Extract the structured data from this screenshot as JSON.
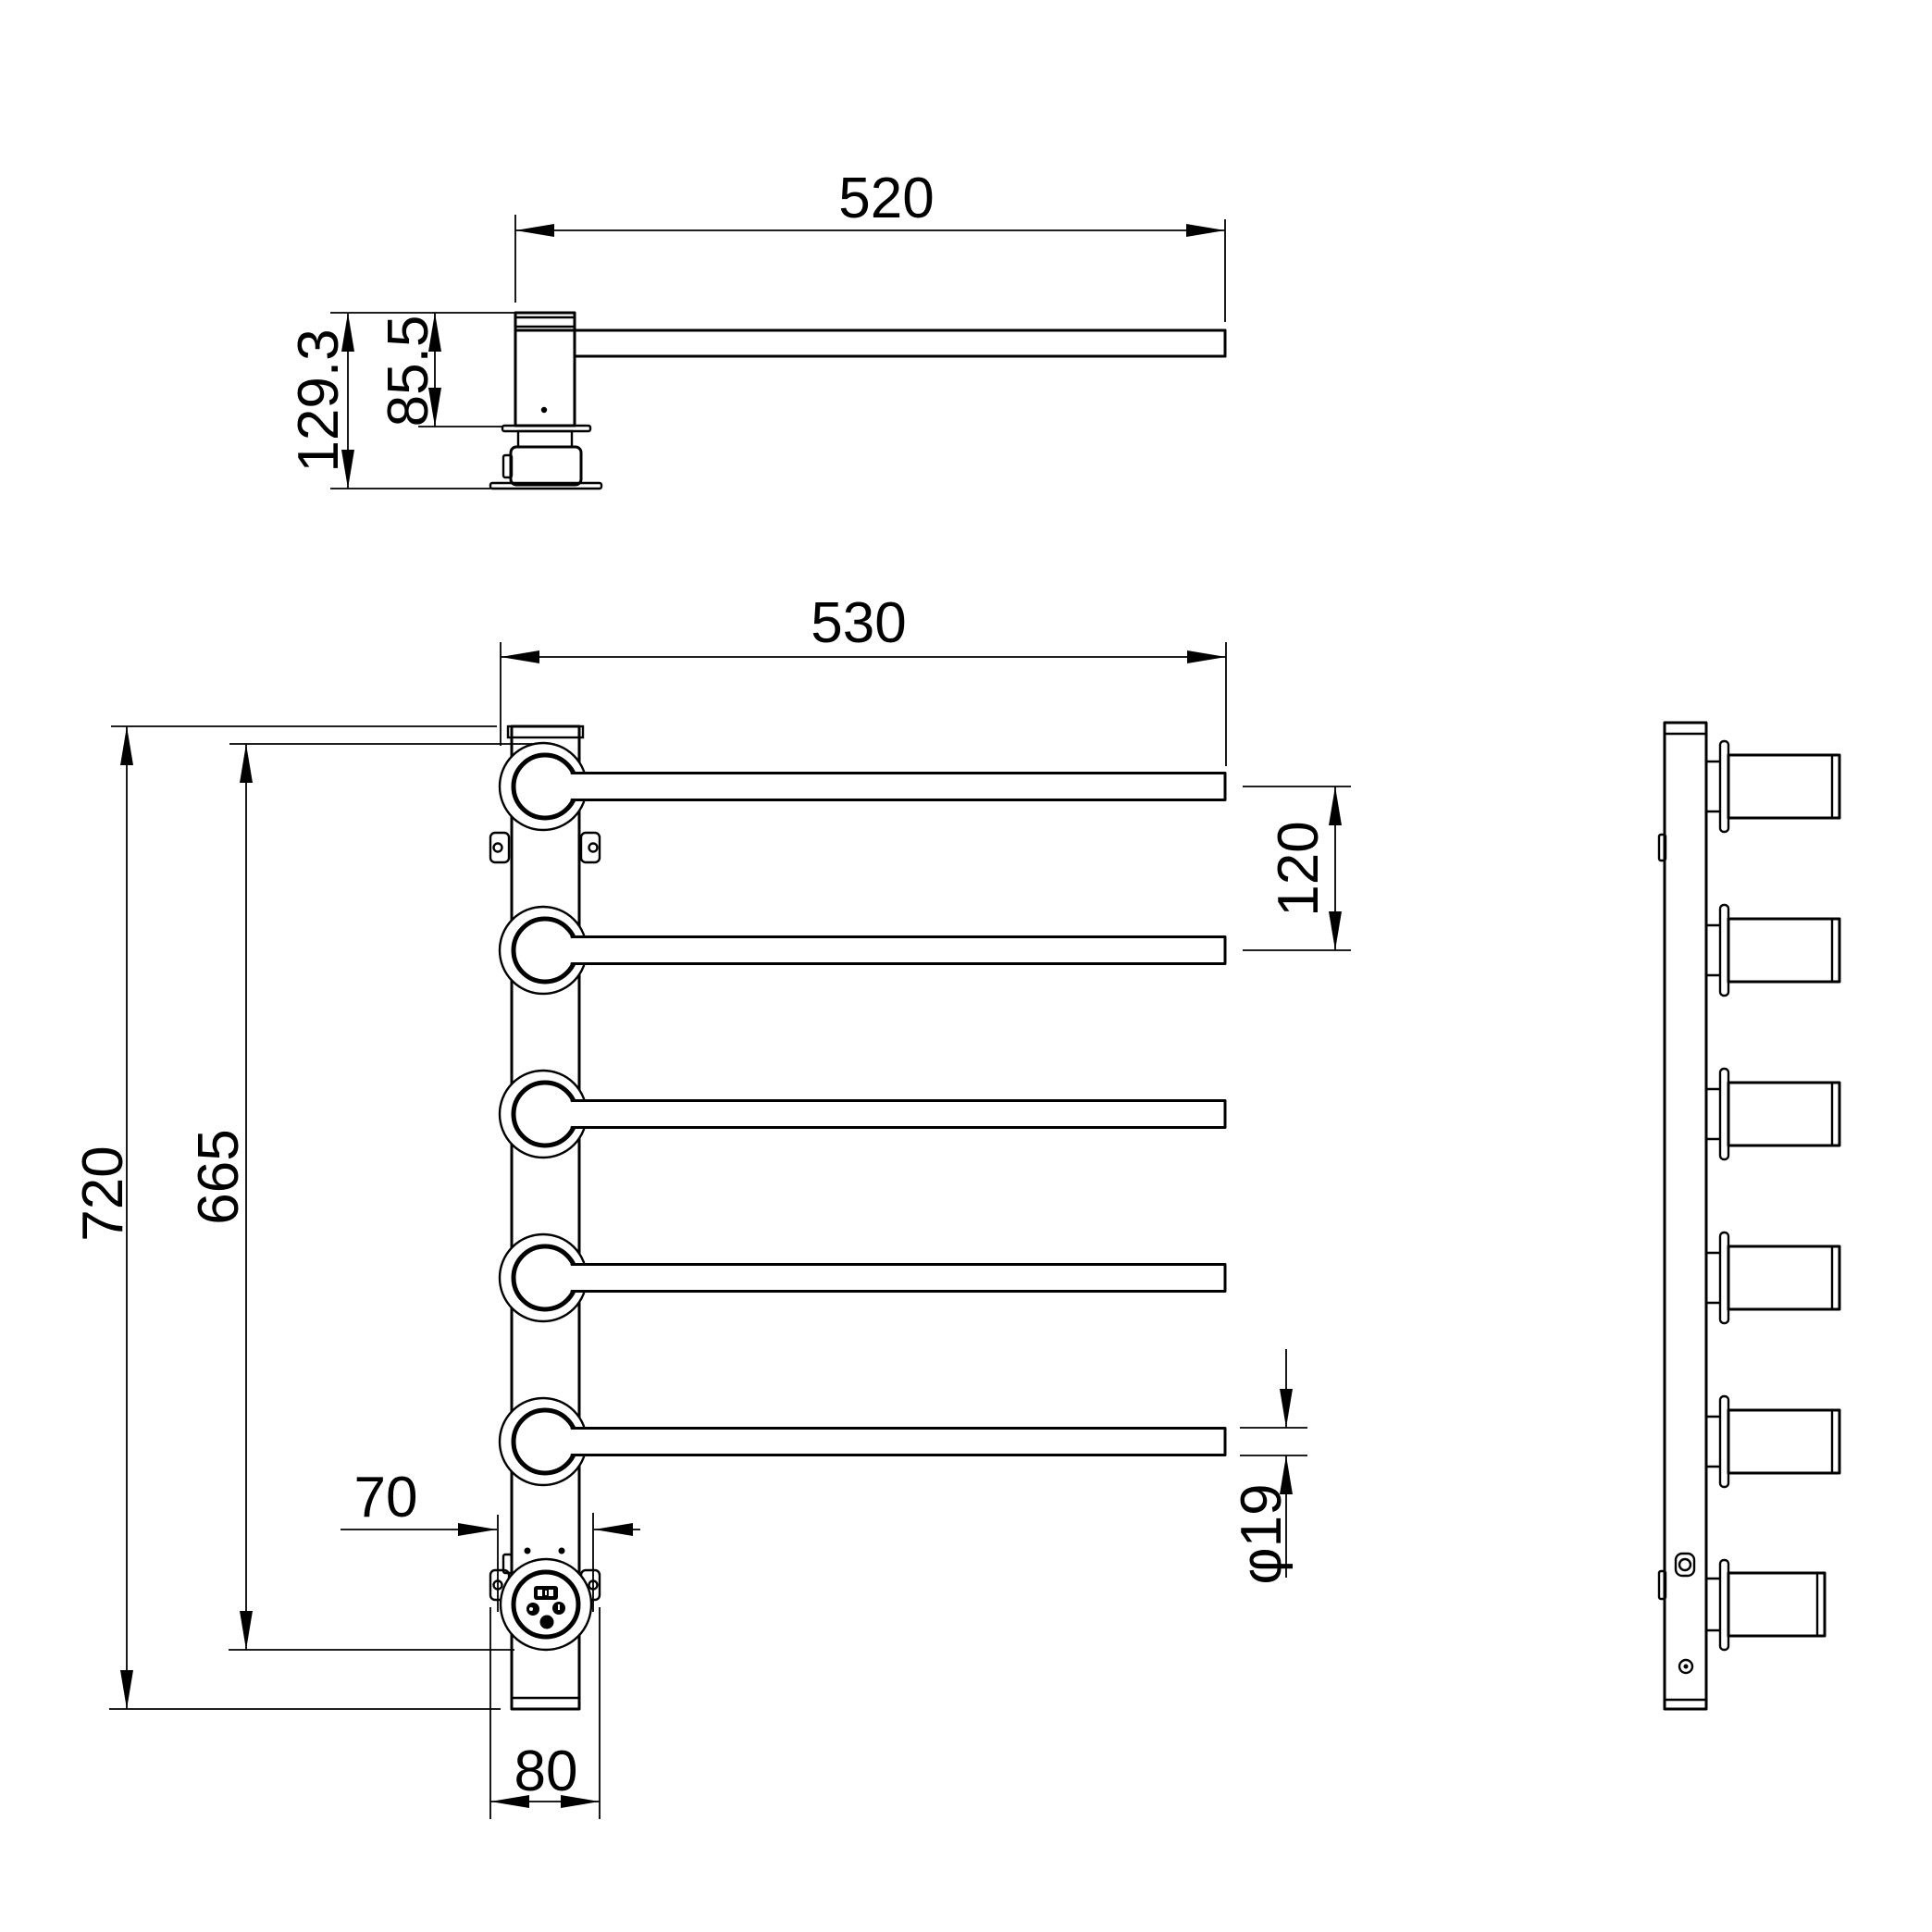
{
  "drawing": {
    "background": "#ffffff",
    "line_color": "#000000",
    "views": {
      "top": {
        "label": "top-view",
        "dims": {
          "arm_length": "520",
          "total_height": "129.3",
          "body_height": "85.5"
        }
      },
      "front": {
        "label": "front-view",
        "dims": {
          "bar_length": "530",
          "total_height": "720",
          "inner_height": "665",
          "bar_pitch": "120",
          "screw_spacing": "70",
          "base_width": "80",
          "bar_diameter": "φ19"
        }
      },
      "side": {
        "label": "side-view"
      }
    }
  }
}
